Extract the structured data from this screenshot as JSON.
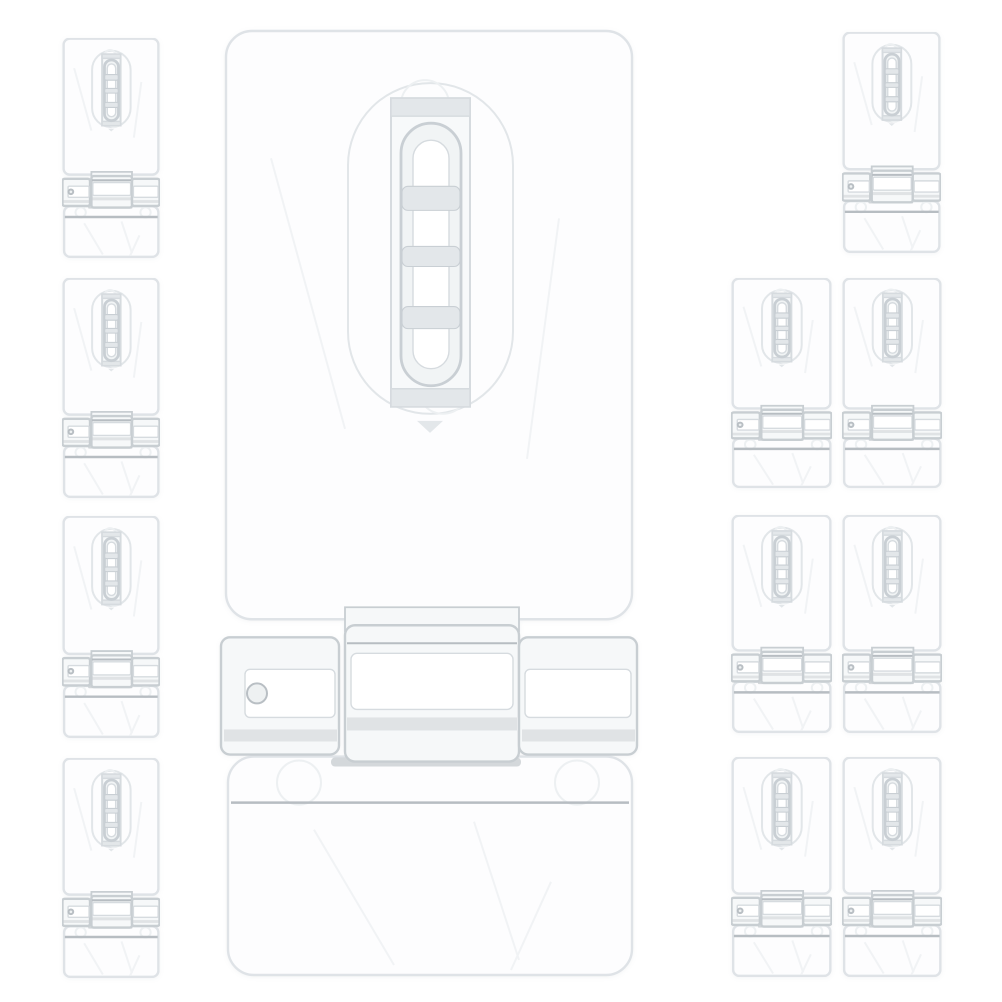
{
  "scene": {
    "type": "product-photo",
    "subject": "Clear transparent plastic hasp latch locks (hinged hasp with staple loop)",
    "background_color": "#ffffff",
    "item_count": 12,
    "large_count": 1,
    "small_count": 11,
    "arrangement": "one large hasp centered vertically; column of four small hasps on the left; one small hasp at top right; three rows of two small hasps on the lower right"
  },
  "palette": {
    "background": "#ffffff",
    "plate_fill": "#fdfdfe",
    "plate_edge": "#dfe3e7",
    "recess_edge": "#e2e6e9",
    "slot_fill": "#f7f9fa",
    "slot_edge": "#d6dbdf",
    "loop_fill": "#f1f4f5",
    "loop_edge": "#c9cfd4",
    "loop_inner": "#ffffff",
    "band_fill": "#e3e7ea",
    "hinge_fill": "#f6f8f9",
    "hinge_edge": "#c8ced2",
    "hinge_line": "#b7bdc2",
    "dark_bar": "#c9ced2",
    "faint_edge": "#edf0f2",
    "crease": "#f1f3f5",
    "hole_edge": "#b9bfc4",
    "hole_fill": "#eef1f2"
  },
  "items": [
    {
      "name": "hasp-latch-large-center",
      "size": "large",
      "x": 219,
      "y": 28,
      "w": 420,
      "h": 952
    },
    {
      "name": "hasp-latch-small-left-1",
      "size": "small",
      "x": 62,
      "y": 38,
      "w": 98,
      "h": 220
    },
    {
      "name": "hasp-latch-small-left-2",
      "size": "small",
      "x": 62,
      "y": 278,
      "w": 98,
      "h": 220
    },
    {
      "name": "hasp-latch-small-left-3",
      "size": "small",
      "x": 62,
      "y": 516,
      "w": 98,
      "h": 222
    },
    {
      "name": "hasp-latch-small-left-4",
      "size": "small",
      "x": 62,
      "y": 758,
      "w": 98,
      "h": 220
    },
    {
      "name": "hasp-latch-small-right-top",
      "size": "small",
      "x": 842,
      "y": 32,
      "w": 99,
      "h": 221
    },
    {
      "name": "hasp-latch-small-right-row2-a",
      "size": "small",
      "x": 731,
      "y": 278,
      "w": 101,
      "h": 210
    },
    {
      "name": "hasp-latch-small-right-row2-b",
      "size": "small",
      "x": 842,
      "y": 278,
      "w": 100,
      "h": 210
    },
    {
      "name": "hasp-latch-small-right-row3-a",
      "size": "small",
      "x": 731,
      "y": 515,
      "w": 101,
      "h": 218
    },
    {
      "name": "hasp-latch-small-right-row3-b",
      "size": "small",
      "x": 842,
      "y": 515,
      "w": 100,
      "h": 218
    },
    {
      "name": "hasp-latch-small-right-row4-a",
      "size": "small",
      "x": 731,
      "y": 757,
      "w": 101,
      "h": 220
    },
    {
      "name": "hasp-latch-small-right-row4-b",
      "size": "small",
      "x": 842,
      "y": 757,
      "w": 100,
      "h": 220
    }
  ]
}
